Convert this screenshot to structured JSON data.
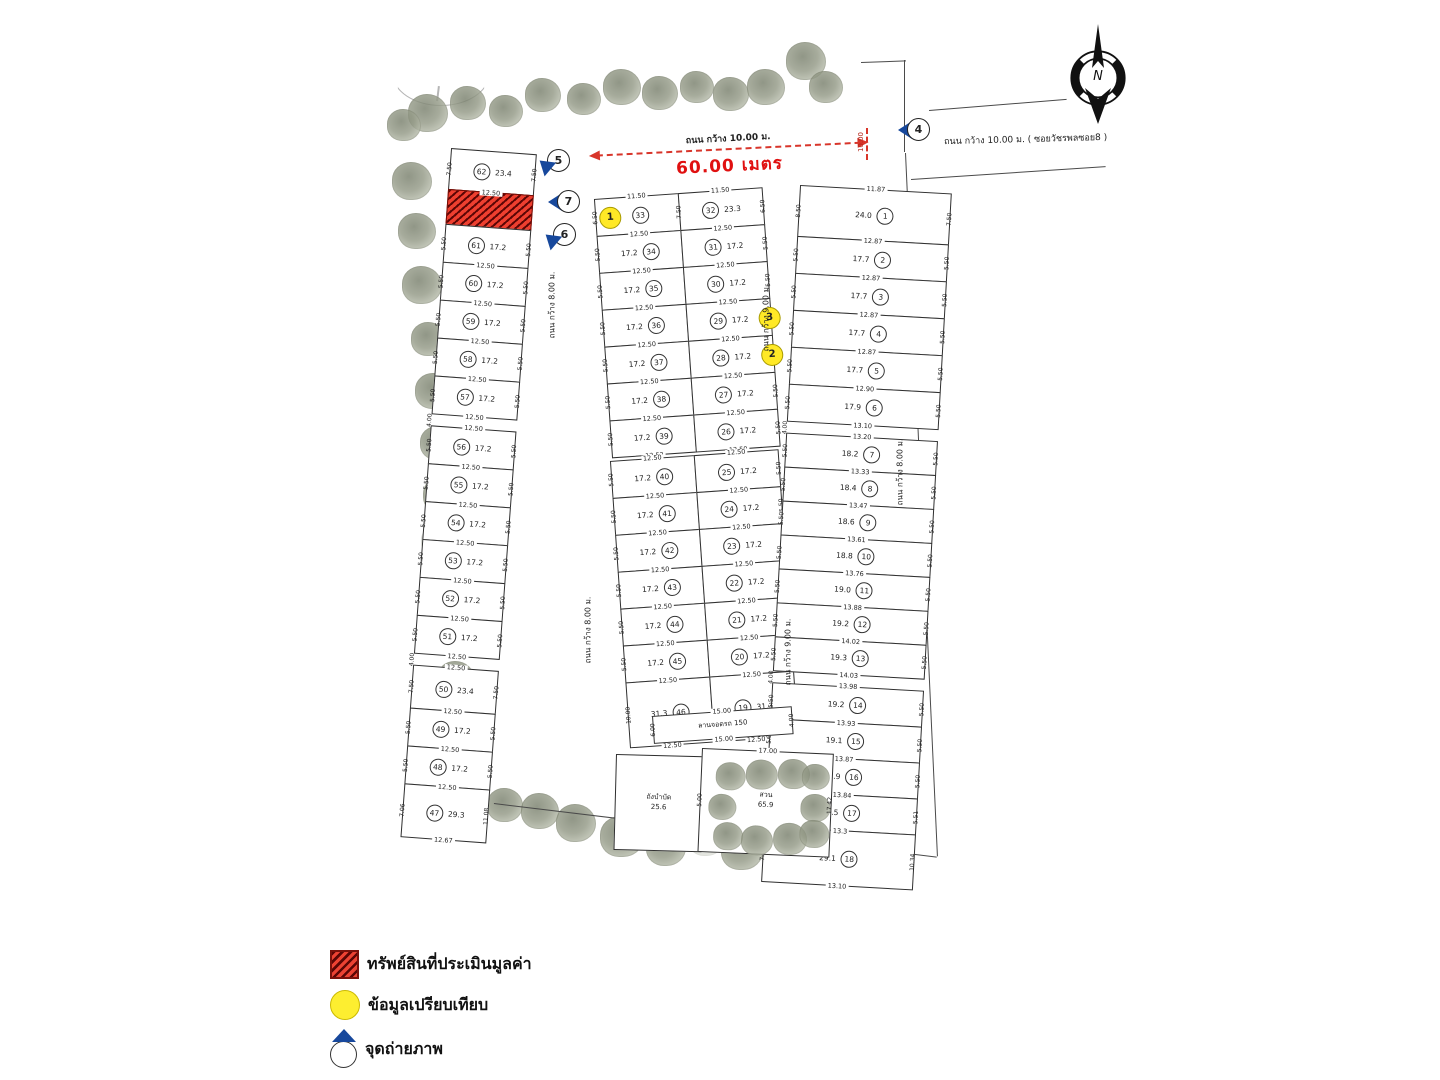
{
  "legend": {
    "items": [
      {
        "icon": "red-hatched-square",
        "label": "ทรัพย์สินที่ประเมินมูลค่า"
      },
      {
        "icon": "yellow-circle",
        "label": "ข้อมูลเปรียบเทียบ"
      },
      {
        "icon": "camera-point",
        "label": "จุดถ่ายภาพ"
      }
    ]
  },
  "compass": {
    "label": "N"
  },
  "roads": {
    "top_main": "ถนน กว้าง 10.00 ม.",
    "soi": "ถนน กว้าง 10.00 ม. ( ซอยวัชรพลซอย8 )",
    "w8": "ถนน กว้าง 8.00 ม.",
    "w9": "ถนน กว้าง 9.00 ม."
  },
  "dimension": {
    "length": "60.00 เมตร",
    "width_tick": "10.00"
  },
  "camera_points": [
    {
      "id": "4"
    },
    {
      "id": "5"
    },
    {
      "id": "7"
    },
    {
      "id": "6"
    }
  ],
  "colors": {
    "subject_red": "#d92b20",
    "comparable_yellow": "#ffe926",
    "camera_blue": "#17489c",
    "dimension_red": "#d8352a"
  },
  "amenities": {
    "parking": {
      "label": "ลานจอดรถ 150",
      "top_dim": "15.00",
      "bottom_dim": "15.00",
      "left_dim": "6.00",
      "right_dim": "4.00"
    },
    "tank": {
      "label": "ถังบำบัด",
      "area": "25.6"
    },
    "garden": {
      "label": "สวน",
      "area": "65.9",
      "top_dim": "17.00",
      "left_dim": "5.00",
      "right_dim": "17.42"
    }
  },
  "blocks": {
    "left": {
      "lots": [
        {
          "no": "62",
          "area": "23.4",
          "w": "12.50",
          "sl": "7.50",
          "sr": "7.50",
          "h": 40
        },
        {
          "subject": true,
          "h": 34
        },
        {
          "no": "61",
          "area": "17.2",
          "w": "12.50",
          "sl": "5.50",
          "sr": "5.50"
        },
        {
          "no": "60",
          "area": "17.2",
          "w": "12.50",
          "sl": "5.50",
          "sr": "5.50"
        },
        {
          "no": "59",
          "area": "17.2",
          "w": "12.50",
          "sl": "5.50",
          "sr": "5.50"
        },
        {
          "no": "58",
          "area": "17.2",
          "w": "12.50",
          "sl": "5.50",
          "sr": "5.50"
        },
        {
          "no": "57",
          "area": "17.2",
          "w": "12.50",
          "sl": "5.50",
          "sr": "5.50"
        },
        {
          "gap": "4.00"
        },
        {
          "no": "56",
          "top": "12.50",
          "area": "17.2",
          "w": "12.50",
          "sl": "5.50",
          "sr": "5.50"
        },
        {
          "no": "55",
          "area": "17.2",
          "w": "12.50",
          "sl": "5.50",
          "sr": "5.50"
        },
        {
          "no": "54",
          "area": "17.2",
          "w": "12.50",
          "sl": "5.50",
          "sr": "5.50"
        },
        {
          "no": "53",
          "area": "17.2",
          "w": "12.50",
          "sl": "5.50",
          "sr": "5.50"
        },
        {
          "no": "52",
          "area": "17.2",
          "w": "12.50",
          "sl": "5.50",
          "sr": "5.50"
        },
        {
          "no": "51",
          "area": "17.2",
          "w": "12.50",
          "sl": "5.50",
          "sr": "5.50"
        },
        {
          "gap": "4.00"
        },
        {
          "no": "50",
          "top": "12.50",
          "area": "23.4",
          "w": "12.50",
          "sl": "7.50",
          "sr": "7.50",
          "h": 42
        },
        {
          "no": "49",
          "area": "17.2",
          "w": "12.50",
          "sl": "5.50",
          "sr": "5.50"
        },
        {
          "no": "48",
          "area": "17.2",
          "w": "12.50",
          "sl": "5.50",
          "sr": "5.50"
        },
        {
          "no": "47",
          "area": "29.3",
          "w": "12.67",
          "sl": "7.06",
          "sr": "11.08",
          "h": 52
        }
      ]
    },
    "mid_upper": {
      "left": [
        {
          "no": "33",
          "top": "11.50",
          "w": "12.50",
          "sl": "6.50",
          "marker": "1",
          "mpos": "l"
        },
        {
          "no": "34",
          "area": "17.2",
          "w": "12.50",
          "sl": "5.50"
        },
        {
          "no": "35",
          "area": "17.2",
          "w": "12.50",
          "sl": "5.50"
        },
        {
          "no": "36",
          "area": "17.2",
          "w": "12.50",
          "sl": "5.50"
        },
        {
          "no": "37",
          "area": "17.2",
          "w": "12.50",
          "sl": "5.50"
        },
        {
          "no": "38",
          "area": "17.2",
          "w": "12.50",
          "sl": "5.50"
        },
        {
          "no": "39",
          "area": "17.2",
          "w": "12.52",
          "sl": "5.50"
        }
      ],
      "right": [
        {
          "no": "32",
          "top": "11.50",
          "area": "23.3",
          "w": "12.50",
          "sl": "7.50",
          "sr": "6.50"
        },
        {
          "no": "31",
          "area": "17.2",
          "w": "12.50",
          "sr": "5.50"
        },
        {
          "no": "30",
          "area": "17.2",
          "w": "12.50",
          "sr": "5.50"
        },
        {
          "no": "29",
          "area": "17.2",
          "w": "12.50",
          "sr": "5.50",
          "marker": "3",
          "mpos": "r"
        },
        {
          "no": "28",
          "area": "17.2",
          "w": "12.50",
          "sr": "5.50",
          "marker": "2",
          "mpos": "r"
        },
        {
          "no": "27",
          "area": "17.2",
          "w": "12.50",
          "sr": "5.50"
        },
        {
          "no": "26",
          "area": "17.2",
          "w": "12.50",
          "sr": "5.50"
        }
      ]
    },
    "mid_lower": {
      "left": [
        {
          "no": "40",
          "top": "12.50",
          "area": "17.2",
          "w": "12.50",
          "sl": "5.50"
        },
        {
          "no": "41",
          "area": "17.2",
          "w": "12.50",
          "sl": "5.50"
        },
        {
          "no": "42",
          "area": "17.2",
          "w": "12.50",
          "sl": "5.50"
        },
        {
          "no": "43",
          "area": "17.2",
          "w": "12.50",
          "sl": "5.50"
        },
        {
          "no": "44",
          "area": "17.2",
          "w": "12.50",
          "sl": "5.50"
        },
        {
          "no": "45",
          "area": "17.2",
          "w": "12.50",
          "sl": "5.50"
        },
        {
          "no": "46",
          "area": "31.3",
          "w": "12.50",
          "sl": "10.00",
          "h": 64
        }
      ],
      "right": [
        {
          "no": "25",
          "top": "12.50",
          "area": "17.2",
          "w": "12.50",
          "sr": "5.50"
        },
        {
          "no": "24",
          "area": "17.2",
          "w": "12.50",
          "sr": "5.50"
        },
        {
          "no": "23",
          "area": "17.2",
          "w": "12.50",
          "sr": "5.50"
        },
        {
          "no": "22",
          "area": "17.2",
          "w": "12.50",
          "sr": "5.50"
        },
        {
          "no": "21",
          "area": "17.2",
          "w": "12.50",
          "sr": "5.50"
        },
        {
          "no": "20",
          "area": "17.2",
          "w": "12.50",
          "sr": "5.50"
        },
        {
          "no": "19",
          "area": "31.3",
          "w": "12.50",
          "sr": "10.00",
          "h": 64
        }
      ]
    },
    "right": {
      "lots": [
        {
          "no": "1",
          "top": "11.87",
          "area": "24.0",
          "w": "12.87",
          "sl": "8.50",
          "sr": "7.50",
          "h": 50
        },
        {
          "no": "2",
          "area": "17.7",
          "w": "12.87",
          "sl": "5.50",
          "sr": "5.50"
        },
        {
          "no": "3",
          "area": "17.7",
          "w": "12.87",
          "sl": "5.50",
          "sr": "5.50"
        },
        {
          "no": "4",
          "area": "17.7",
          "w": "12.87",
          "sl": "5.50",
          "sr": "5.50"
        },
        {
          "no": "5",
          "area": "17.7",
          "w": "12.90",
          "sl": "5.50",
          "sr": "5.50"
        },
        {
          "no": "6",
          "area": "17.9",
          "w": "13.10",
          "sl": "5.50",
          "sr": "5.50"
        },
        {
          "gap": "4.00"
        },
        {
          "no": "7",
          "top": "13.20",
          "area": "18.2",
          "w": "13.33",
          "sl": "5.50",
          "sr": "5.50",
          "h": 33
        },
        {
          "no": "8",
          "area": "18.4",
          "w": "13.47",
          "sl": "5.50",
          "sr": "5.50",
          "h": 33
        },
        {
          "no": "9",
          "area": "18.6",
          "w": "13.61",
          "sl": "5.50",
          "sr": "5.50",
          "h": 33
        },
        {
          "no": "10",
          "area": "18.8",
          "w": "13.76",
          "sl": "5.50",
          "sr": "5.50",
          "h": 33
        },
        {
          "no": "11",
          "area": "19.0",
          "w": "13.88",
          "sl": "5.50",
          "sr": "5.50",
          "h": 33
        },
        {
          "no": "12",
          "area": "19.2",
          "w": "14.02",
          "sl": "5.50",
          "sr": "5.50",
          "h": 33
        },
        {
          "no": "13",
          "area": "19.3",
          "w": "14.03",
          "sl": "5.50",
          "sr": "5.50",
          "h": 33
        },
        {
          "gap": "4.00"
        },
        {
          "no": "14",
          "top": "13.98",
          "area": "19.2",
          "w": "13.93",
          "sl": "5.50",
          "sr": "5.50",
          "h": 35
        },
        {
          "no": "15",
          "area": "19.1",
          "w": "13.87",
          "sl": "5.50",
          "sr": "5.50",
          "h": 35
        },
        {
          "no": "16",
          "area": "18.9",
          "w": "13.84",
          "sl": "5.50",
          "sr": "5.50",
          "h": 35
        },
        {
          "no": "17",
          "area": "18.5",
          "w": "13.3",
          "sl": "5.50",
          "sr": "5.51",
          "h": 35
        },
        {
          "no": "18",
          "area": "29.1",
          "w": "13.10",
          "sl": "7.44",
          "sr": "10.34",
          "h": 54
        }
      ]
    }
  },
  "decor": {
    "trees": [
      [
        543,
        96,
        36
      ],
      [
        584,
        100,
        34
      ],
      [
        622,
        88,
        38
      ],
      [
        660,
        94,
        36
      ],
      [
        697,
        88,
        34
      ],
      [
        731,
        95,
        36
      ],
      [
        766,
        88,
        38
      ],
      [
        806,
        62,
        40
      ],
      [
        826,
        88,
        34
      ],
      [
        428,
        114,
        40
      ],
      [
        468,
        104,
        36
      ],
      [
        506,
        112,
        34
      ],
      [
        404,
        126,
        34
      ],
      [
        412,
        182,
        40
      ],
      [
        417,
        232,
        38
      ],
      [
        422,
        286,
        40
      ],
      [
        429,
        340,
        36
      ],
      [
        434,
        392,
        38
      ],
      [
        438,
        444,
        36
      ],
      [
        443,
        496,
        40
      ],
      [
        438,
        542,
        34,
        1
      ],
      [
        446,
        588,
        38
      ],
      [
        450,
        634,
        40
      ],
      [
        456,
        680,
        38
      ],
      [
        460,
        726,
        36
      ],
      [
        448,
        770,
        46
      ],
      [
        468,
        800,
        44
      ],
      [
        505,
        806,
        36
      ],
      [
        540,
        812,
        38
      ],
      [
        576,
        824,
        40
      ],
      [
        622,
        838,
        44
      ],
      [
        666,
        848,
        40
      ],
      [
        706,
        840,
        36,
        1
      ],
      [
        742,
        852,
        42
      ],
      [
        782,
        858,
        40
      ],
      [
        822,
        860,
        42
      ],
      [
        862,
        864,
        40
      ],
      [
        724,
        228,
        40,
        1
      ]
    ],
    "garden_trees": [
      [
        14,
        12,
        30
      ],
      [
        44,
        8,
        32
      ],
      [
        76,
        6,
        32
      ],
      [
        100,
        10,
        28
      ],
      [
        8,
        44,
        28
      ],
      [
        100,
        40,
        30
      ],
      [
        14,
        72,
        30
      ],
      [
        42,
        74,
        32
      ],
      [
        74,
        70,
        34
      ],
      [
        100,
        66,
        30
      ]
    ]
  }
}
